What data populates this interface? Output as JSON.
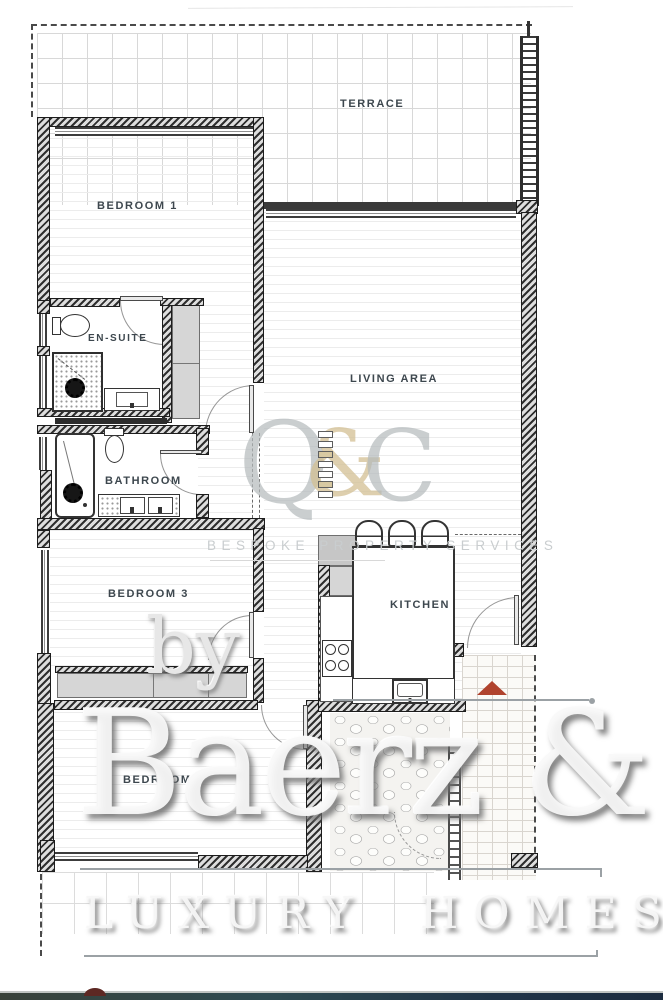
{
  "plan": {
    "rooms": [
      {
        "id": "terrace",
        "label": "TERRACE"
      },
      {
        "id": "bedroom1",
        "label": "BEDROOM 1"
      },
      {
        "id": "ensuite",
        "label": "EN-SUITE"
      },
      {
        "id": "living",
        "label": "LIVING AREA"
      },
      {
        "id": "bathroom",
        "label": "BATHROOM"
      },
      {
        "id": "bedroom3",
        "label": "BEDROOM 3"
      },
      {
        "id": "kitchen",
        "label": "KITCHEN"
      },
      {
        "id": "bedroom2",
        "label": "BEDROOM 2"
      }
    ]
  },
  "watermark": {
    "logo_letter_q": "Q",
    "logo_amp": "&",
    "logo_letter_c": "C",
    "tagline": "BESPOKE PROPERTY SERVICES",
    "by": "by",
    "brand": "Baerz & Co",
    "brand_sub": "LUXURY HOMES"
  },
  "colors": {
    "wall": "#2f2f2f",
    "logo_gray": "#b4babc",
    "logo_tan": "#d3c094",
    "arrow_red": "#b0432e",
    "bar_teal": "#2e4b52",
    "bar_navy": "#1c2c40"
  }
}
